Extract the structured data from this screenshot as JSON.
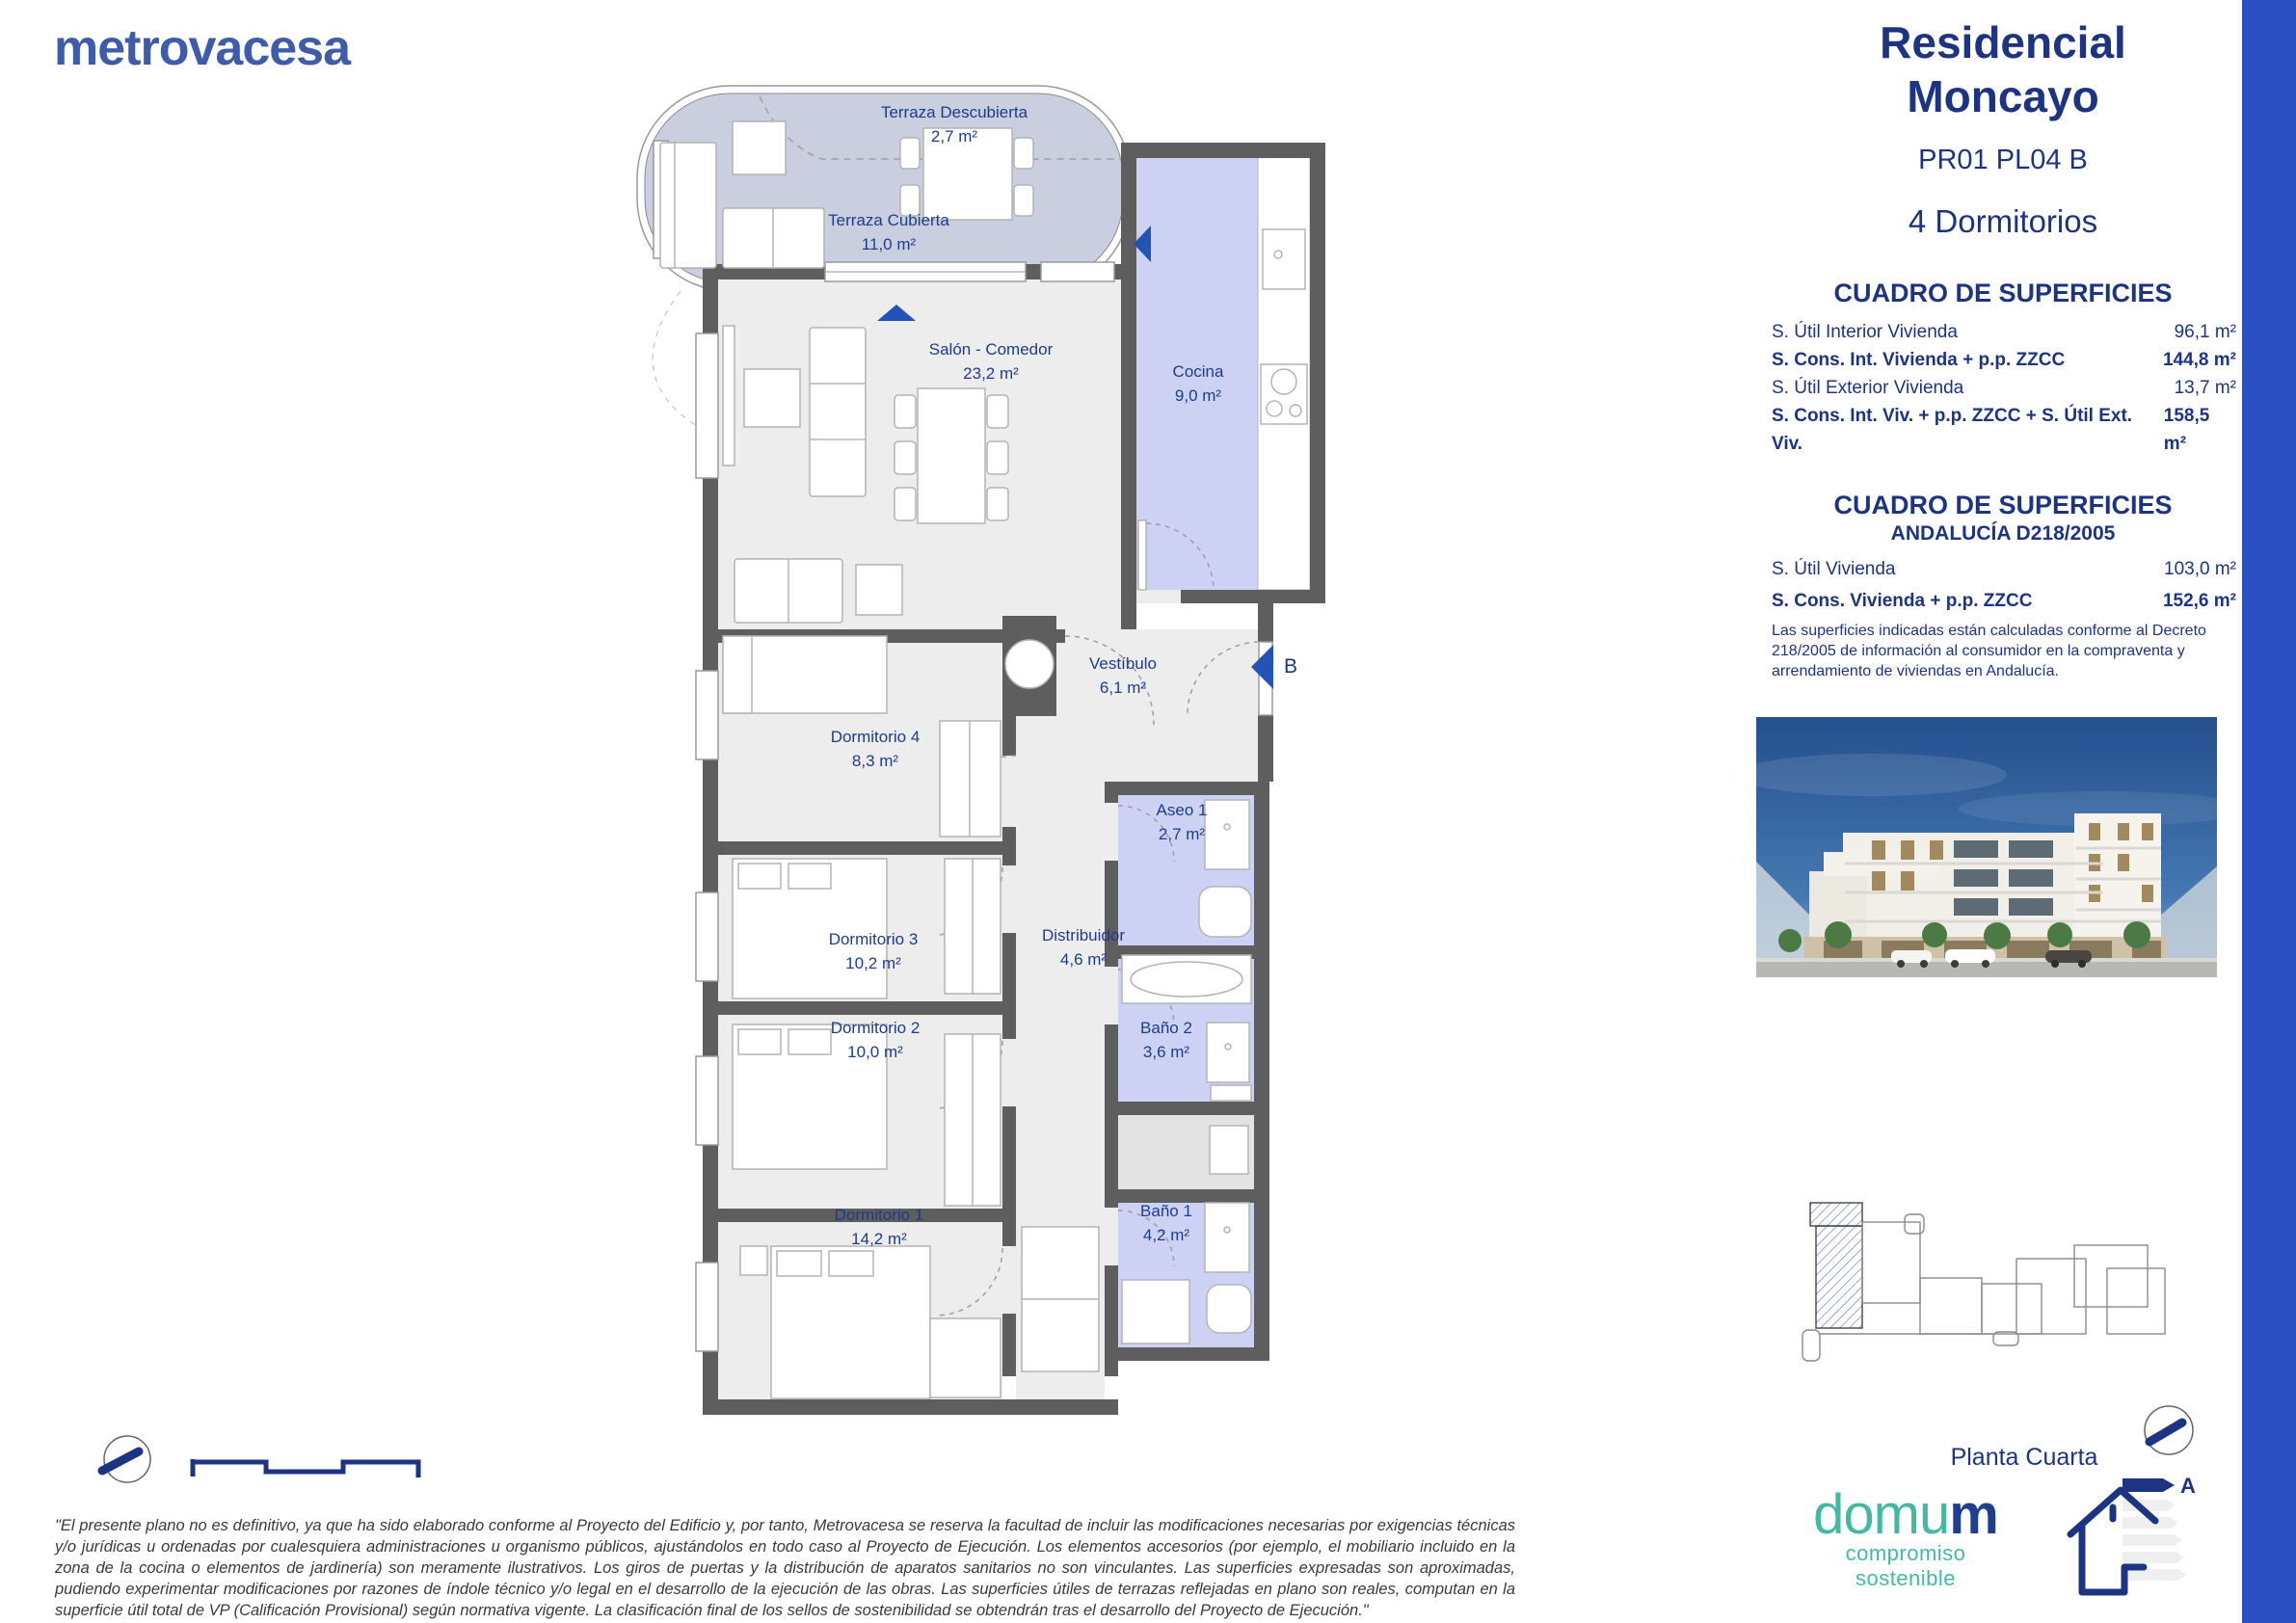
{
  "brand": {
    "logo": "metrovacesa"
  },
  "header": {
    "title_line1": "Residencial",
    "title_line2": "Moncayo",
    "unit_code": "PR01 PL04 B",
    "bedrooms": "4 Dormitorios"
  },
  "surfaces": {
    "title": "CUADRO DE SUPERFICIES",
    "rows": [
      {
        "label": "S. Útil Interior Vivienda",
        "value": "96,1 m²"
      },
      {
        "label": "S. Cons. Int. Vivienda + p.p. ZZCC",
        "value": "144,8 m²"
      },
      {
        "label": "S. Útil Exterior Vivienda",
        "value": "13,7 m²"
      },
      {
        "label": "S. Cons. Int. Viv. + p.p. ZZCC + S. Útil Ext. Viv.",
        "value": "158,5 m²"
      }
    ]
  },
  "andalucia": {
    "title": "CUADRO DE SUPERFICIES",
    "subtitle": "ANDALUCÍA D218/2005",
    "rows": [
      {
        "label": "S. Útil Vivienda",
        "value": "103,0 m²"
      },
      {
        "label": "S. Cons. Vivienda + p.p. ZZCC",
        "value": "152,6 m²"
      }
    ],
    "note": "Las superficies indicadas están calculadas conforme al Decreto 218/2005 de información al consumidor en la compraventa y arrendamiento de viviendas en Andalucía."
  },
  "floorplan": {
    "rooms": [
      {
        "name": "Terraza Descubierta",
        "area": "2,7 m²"
      },
      {
        "name": "Terraza Cubierta",
        "area": "11,0 m²"
      },
      {
        "name": "Salón - Comedor",
        "area": "23,2 m²"
      },
      {
        "name": "Cocina",
        "area": "9,0 m²"
      },
      {
        "name": "Vestíbulo",
        "area": "6,1 m²"
      },
      {
        "name": "Dormitorio 4",
        "area": "8,3 m²"
      },
      {
        "name": "Aseo 1",
        "area": "2,7 m²"
      },
      {
        "name": "Dormitorio 3",
        "area": "10,2 m²"
      },
      {
        "name": "Distribuidor",
        "area": "4,6 m²"
      },
      {
        "name": "Baño 2",
        "area": "3,6 m²"
      },
      {
        "name": "Dormitorio 2",
        "area": "10,0 m²"
      },
      {
        "name": "Dormitorio 1",
        "area": "14,2 m²"
      },
      {
        "name": "Baño 1",
        "area": "4,2 m²"
      }
    ],
    "markers": {
      "section_b": "B"
    }
  },
  "energy": {
    "rating": "A"
  },
  "footer": {
    "floor_label": "Planta Cuarta",
    "disclaimer": "\"El presente plano no es definitivo, ya que ha sido elaborado conforme al Proyecto del Edificio y, por tanto, Metrovacesa se reserva la facultad de incluir las modificaciones necesarias por exigencias técnicas y/o jurídicas u ordenadas por cualesquiera administraciones u organismo públicos, ajustándolos en todo caso al Proyecto de Ejecución. Los elementos accesorios (por ejemplo, el mobiliario incluido en la zona de la cocina o elementos de jardinería) son meramente ilustrativos. Los giros de puertas y la distribución de aparatos sanitarios no son vinculantes. Las superficies expresadas son aproximadas, pudiendo experimentar modificaciones por razones de índole técnico y/o legal en el desarrollo de la ejecución de las obras. Las superficies útiles de terrazas reflejadas en plano son reales, computan en la superficie útil total de VP (Calificación Provisional) según normativa vigente. La clasificación final de los sellos de sostenibilidad se obtendrán tras el desarrollo del Proyecto de Ejecución.\""
  },
  "domum": {
    "part1": "domu",
    "part2": "m",
    "tagline": "compromiso sostenible"
  },
  "colors": {
    "accent_blue": "#2a50c4",
    "navy": "#1c3482",
    "terrace_fill": "#c9cfdf",
    "wet_room_fill": "#cdd2f4",
    "wall_gray": "#5e5e5e",
    "logo_blue": "#3e5cab",
    "teal": "#45b8a3"
  }
}
